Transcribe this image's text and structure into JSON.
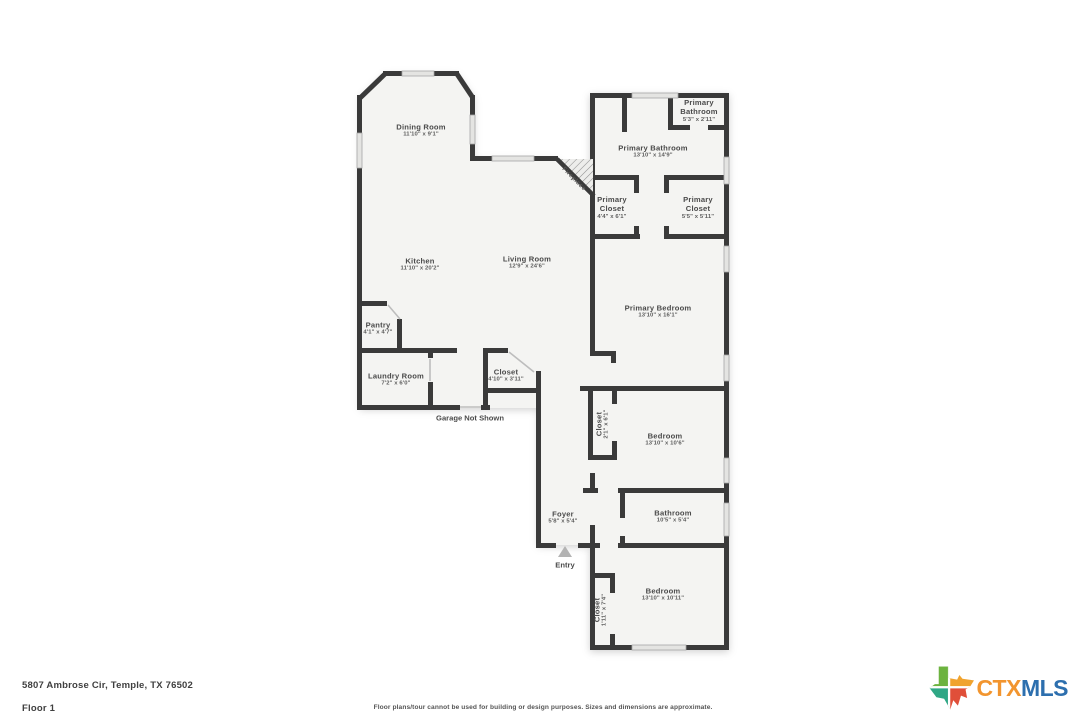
{
  "floorplan": {
    "rooms": {
      "dining": {
        "name": "Dining Room",
        "dims": "11'10\" x 9'1\""
      },
      "kitchen": {
        "name": "Kitchen",
        "dims": "11'10\" x 20'2\""
      },
      "living": {
        "name": "Living Room",
        "dims": "12'9\" x 24'6\""
      },
      "pantry": {
        "name": "Pantry",
        "dims": "4'1\" x 4'7\""
      },
      "laundry": {
        "name": "Laundry Room",
        "dims": "7'2\" x 6'0\""
      },
      "hall_closet": {
        "name": "Closet",
        "dims": "4'10\" x 3'11\""
      },
      "primary_bathroom_wc": {
        "name": "Primary Bathroom",
        "dims": "5'3\" x 2'11\""
      },
      "primary_bathroom": {
        "name": "Primary Bathroom",
        "dims": "13'10\" x 14'9\""
      },
      "primary_closet_left": {
        "name": "Primary Closet",
        "dims": "4'4\" x 6'1\""
      },
      "primary_closet_right": {
        "name": "Primary Closet",
        "dims": "5'5\" x 5'11\""
      },
      "primary_bedroom": {
        "name": "Primary Bedroom",
        "dims": "13'10\" x 16'1\""
      },
      "mid_closet": {
        "name": "Closet",
        "dims": "2'1\" x 6'1\""
      },
      "mid_bedroom": {
        "name": "Bedroom",
        "dims": "13'10\" x 10'6\""
      },
      "foyer": {
        "name": "Foyer",
        "dims": "5'8\" x 5'4\""
      },
      "bathroom": {
        "name": "Bathroom",
        "dims": "10'5\" x 5'4\""
      },
      "bottom_closet": {
        "name": "Closet",
        "dims": "1'11\" x 7'4\""
      },
      "bottom_bedroom": {
        "name": "Bedroom",
        "dims": "13'10\" x 10'11\""
      }
    },
    "annotations": {
      "fireplace": "Fireplace",
      "garage": "Garage Not Shown",
      "entry": "Entry"
    }
  },
  "footer": {
    "address": "5807 Ambrose Cir, Temple, TX 76502",
    "floor_label": "Floor 1",
    "disclaimer": "Floor plans/tour cannot be used for building or design purposes. Sizes and dimensions are approximate.",
    "logo": {
      "ctx": "CTX",
      "mls": "MLS"
    }
  },
  "colors": {
    "wall": "#3a3a3a",
    "floor": "#f4f4f2",
    "ctx_orange": "#F2952F",
    "mls_blue": "#2D6FAE",
    "texas_green": "#6CB33F",
    "texas_orange": "#F0A32F",
    "texas_teal": "#2FA785",
    "texas_red": "#E04F39"
  }
}
